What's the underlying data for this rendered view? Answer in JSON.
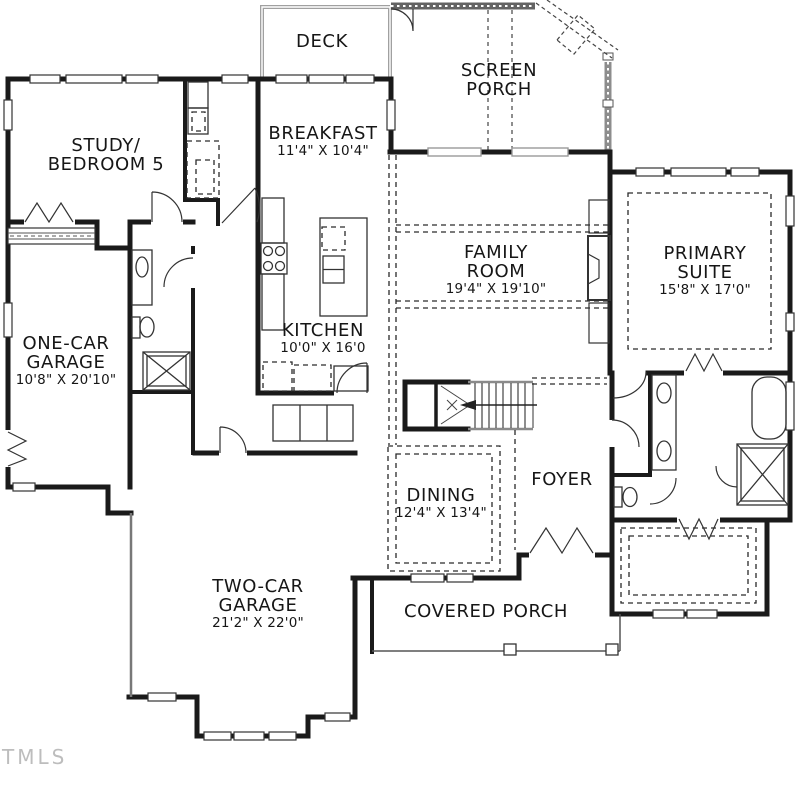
{
  "watermark": "TMLS",
  "colors": {
    "wall": "#1a1a1a",
    "screen_wall": "#8d8d8d",
    "dashed_line": "#2a2a2a",
    "watermark": "#bdbdbd",
    "background": "#ffffff"
  },
  "rooms": {
    "deck": {
      "name": "DECK"
    },
    "screen_porch": {
      "name": "SCREEN",
      "name2": "PORCH"
    },
    "study": {
      "name": "STUDY/",
      "name2": "BEDROOM 5"
    },
    "breakfast": {
      "name": "BREAKFAST",
      "dims": "11'4\" X 10'4\""
    },
    "family_room": {
      "name": "FAMILY",
      "name2": "ROOM",
      "dims": "19'4\" X 19'10\""
    },
    "primary_suite": {
      "name": "PRIMARY",
      "name2": "SUITE",
      "dims": "15'8\" X 17'0\""
    },
    "one_car_garage": {
      "name": "ONE-CAR",
      "name2": "GARAGE",
      "dims": "10'8\" X 20'10\""
    },
    "kitchen": {
      "name": "KITCHEN",
      "dims": "10'0\" X 16'0"
    },
    "dining": {
      "name": "DINING",
      "dims": "12'4\" X 13'4\""
    },
    "foyer": {
      "name": "FOYER"
    },
    "two_car_garage": {
      "name": "TWO-CAR",
      "name2": "GARAGE",
      "dims": "21'2\" X 22'0\""
    },
    "covered_porch": {
      "name": "COVERED PORCH"
    }
  }
}
